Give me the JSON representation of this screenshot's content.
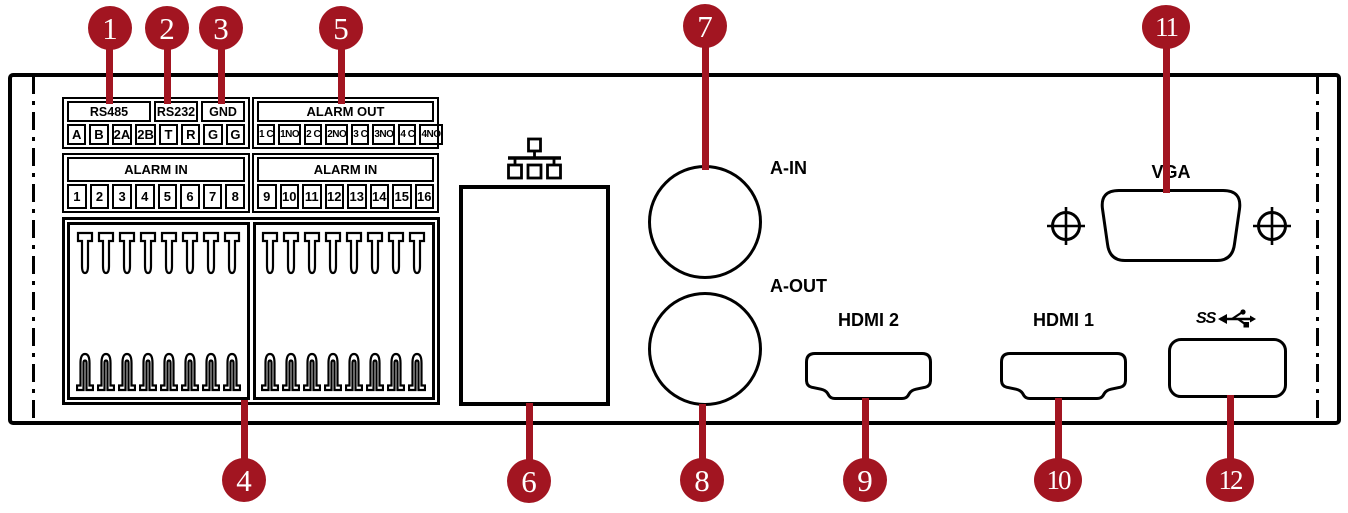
{
  "colors": {
    "callout": "#A21521",
    "line": "#000000",
    "background": "#FFFFFF"
  },
  "strips": [
    {
      "id": "serial",
      "headers": [
        {
          "label": "RS485",
          "span": 4
        },
        {
          "label": "RS232",
          "span": 2
        },
        {
          "label": "GND",
          "span": 2
        }
      ],
      "cells": [
        "A",
        "B",
        "2A",
        "2B",
        "T",
        "R",
        "G",
        "G"
      ]
    },
    {
      "id": "alarm-out",
      "headers": [
        {
          "label": "ALARM OUT",
          "span": 8
        }
      ],
      "cells": [
        "1 C",
        "1NO",
        "2 C",
        "2NO",
        "3 C",
        "3NO",
        "4 C",
        "4NO"
      ]
    },
    {
      "id": "alarm-in-1",
      "headers": [
        {
          "label": "ALARM IN",
          "span": 8
        }
      ],
      "cells": [
        "1",
        "2",
        "3",
        "4",
        "5",
        "6",
        "7",
        "8"
      ]
    },
    {
      "id": "alarm-in-2",
      "headers": [
        {
          "label": "ALARM IN",
          "span": 8
        }
      ],
      "cells": [
        "9",
        "10",
        "11",
        "12",
        "13",
        "14",
        "15",
        "16"
      ]
    }
  ],
  "connector": {
    "halves": 2,
    "pins_per_row": 8
  },
  "ports": {
    "audio_in_label": "A-IN",
    "audio_out_label": "A-OUT",
    "hdmi2_label": "HDMI 2",
    "hdmi1_label": "HDMI 1",
    "vga_label": "VGA",
    "usb_label": "SS"
  },
  "callouts": [
    {
      "label": "1"
    },
    {
      "label": "2"
    },
    {
      "label": "3"
    },
    {
      "label": "4"
    },
    {
      "label": "5"
    },
    {
      "label": "6"
    },
    {
      "label": "7"
    },
    {
      "label": "8"
    },
    {
      "label": "9"
    },
    {
      "label": "10"
    },
    {
      "label": "11"
    },
    {
      "label": "12"
    }
  ]
}
